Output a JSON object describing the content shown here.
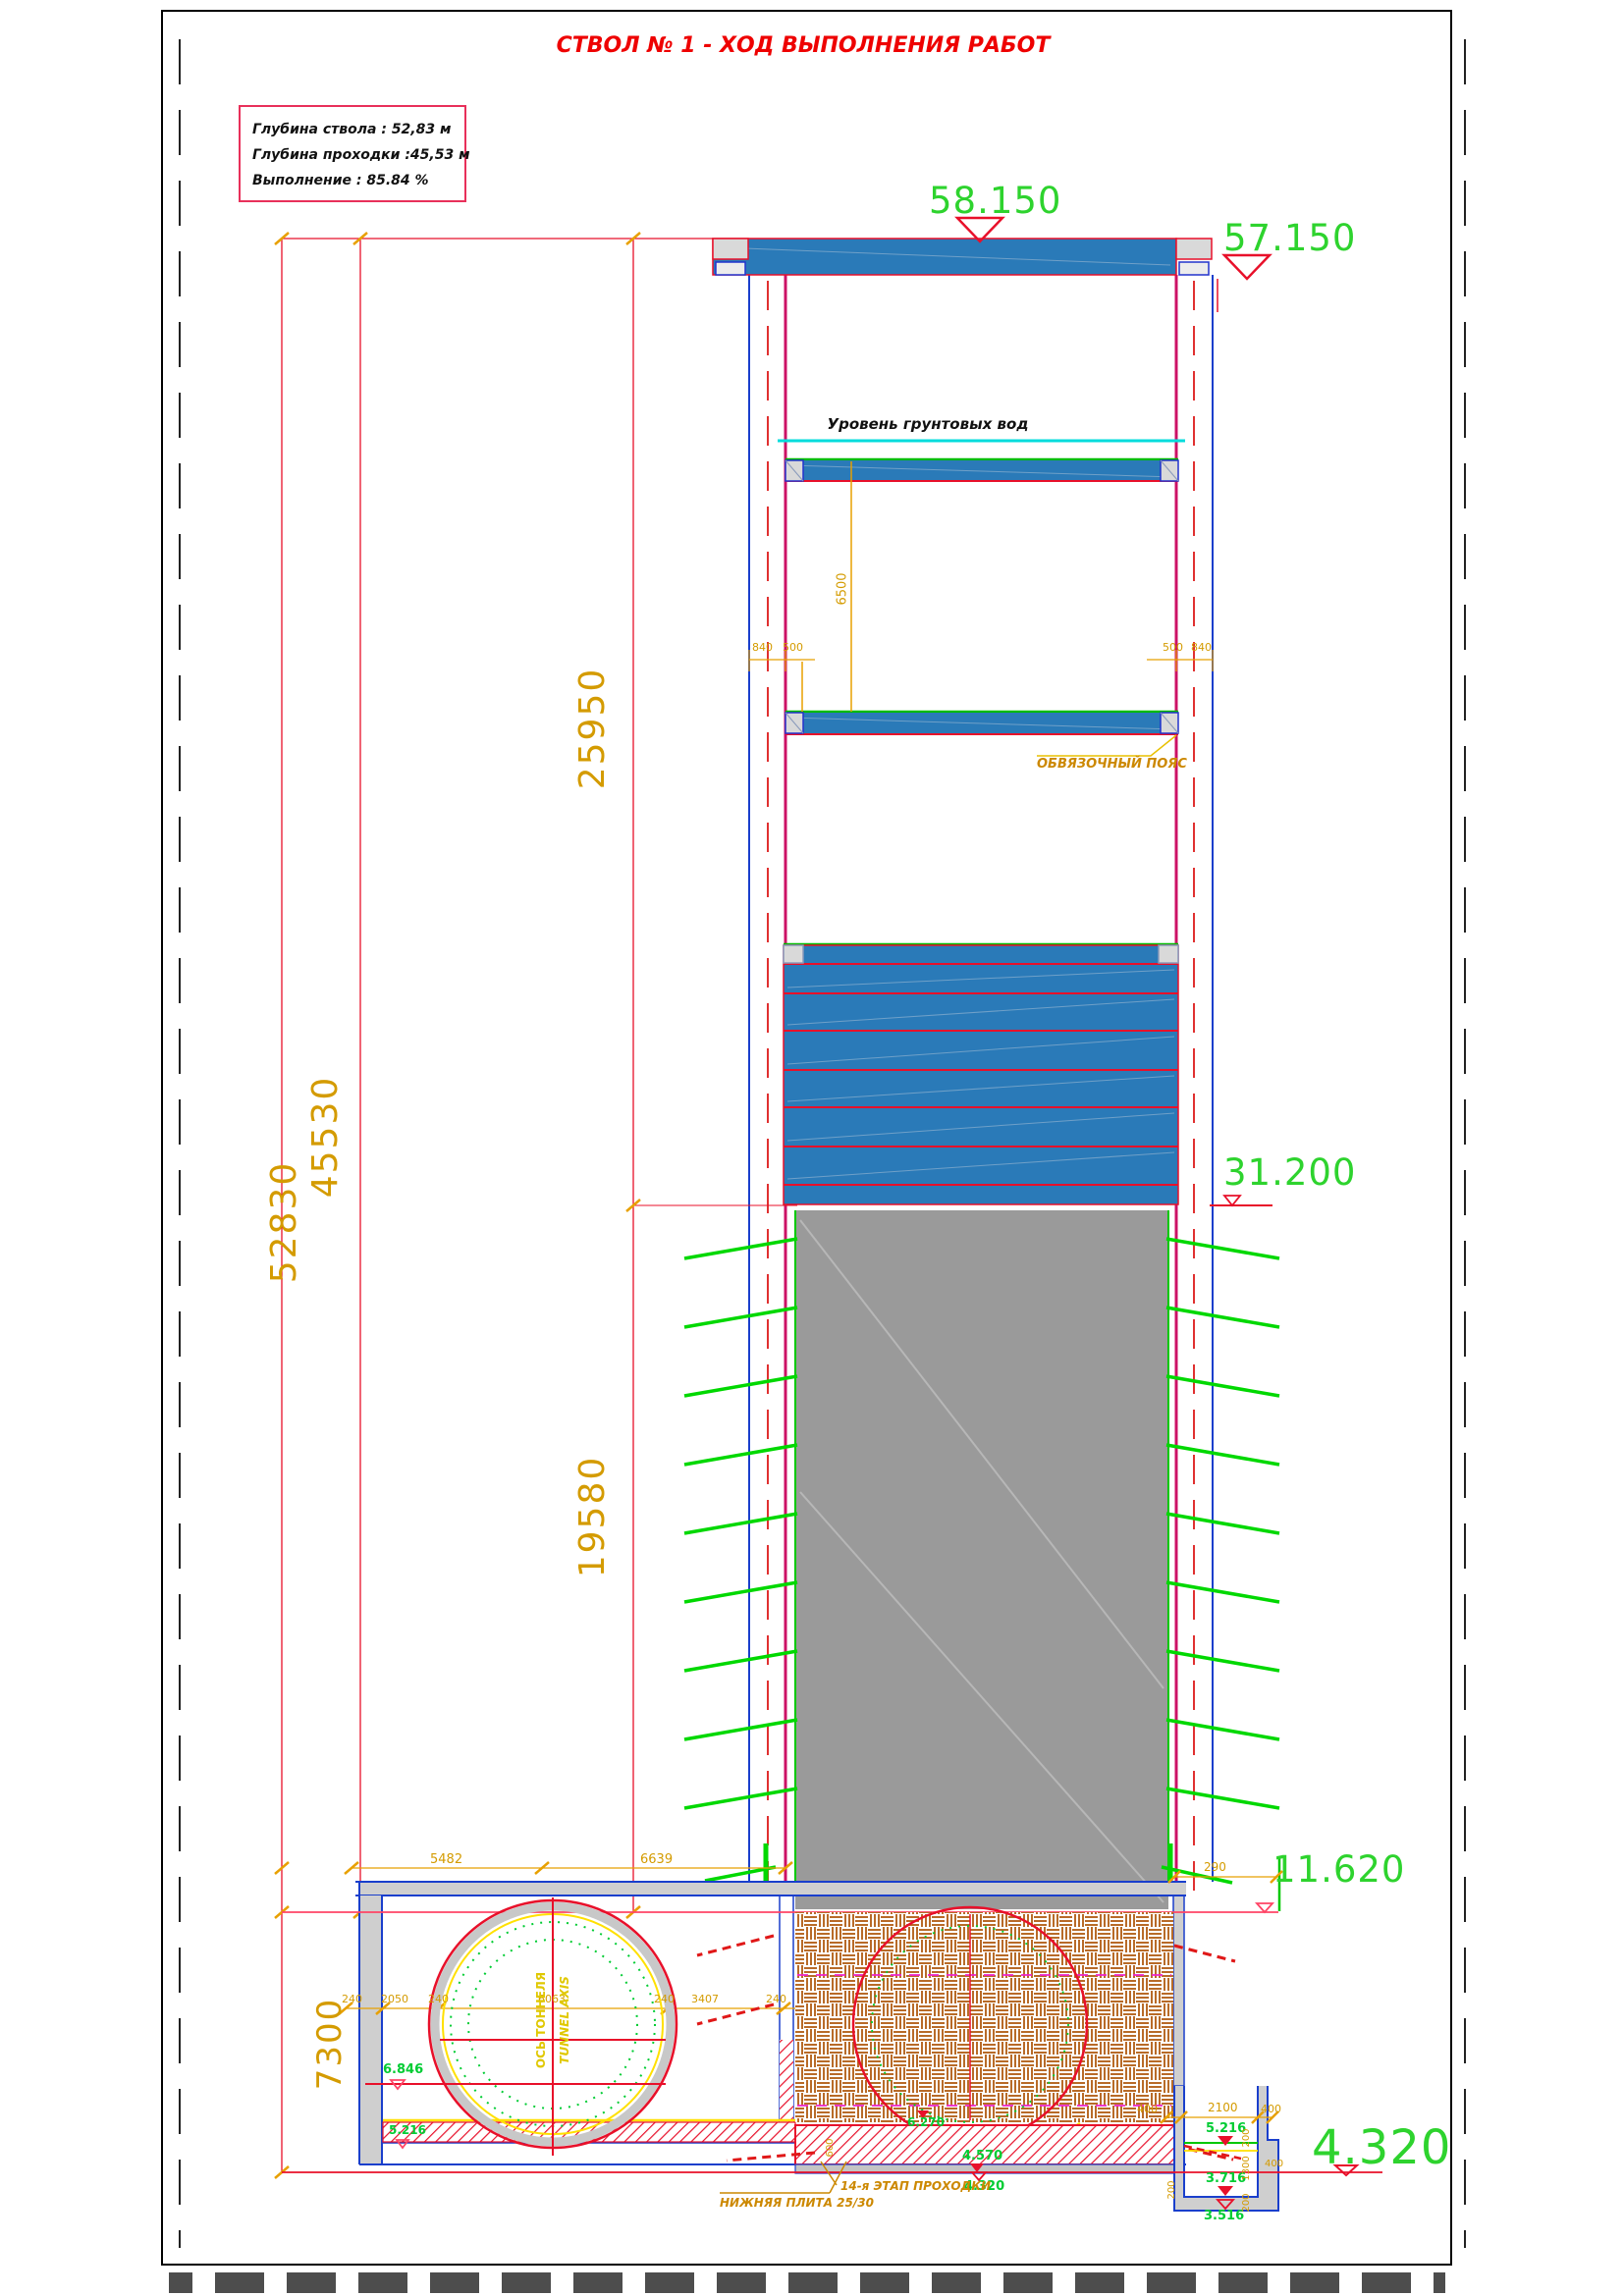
{
  "title": "СТВОЛ № 1 - ХОД ВЫПОЛНЕНИЯ РАБОТ",
  "info": {
    "depth_shaft": "Глубина ствола : 52,83 м",
    "depth_advance": "Глубина проходки :45,53 м",
    "completion": "Выполнение : 85.84 %"
  },
  "labels": {
    "groundwater": "Уровень грунтовых вод",
    "tie_belt": "ОБВЯЗОЧНЫЙ ПОЯС",
    "tunnel_axis_ru": "ОСЬ ТОННЕЛЯ",
    "tunnel_axis_en": "TUNNEL AXIS",
    "bottom_slab": "НИЖНЯЯ ПЛИТА 25/30",
    "stage": "14-я ЭТАП ПРОХОДКИ"
  },
  "elevations": {
    "surface": "58.150",
    "collar": "57.150",
    "lining_bottom": "31.200",
    "excavation_level": "11.620",
    "shaft_bottom_big": "4.320",
    "tunnel_springline": "6.846",
    "gallery_floor": "5.216",
    "masonry_level": "6.270",
    "slab_top": "4.570",
    "slab_bottom": "4.320",
    "sump_top": "5.216",
    "sump_mid": "3.716",
    "sump_bottom": "3.516"
  },
  "dims": {
    "total_depth": "52830",
    "advance_depth": "45530",
    "upper_section": "25950",
    "lower_section": "19580",
    "gallery_height": "7300",
    "level_spacing": "6500",
    "wall_left_a": "840",
    "wall_left_b": "500",
    "wall_right_a": "500",
    "wall_right_b": "840",
    "gallery_top_a": "5482",
    "gallery_top_b": "6639",
    "row": [
      "240",
      "2050",
      "240",
      "6063",
      "240",
      "3407",
      "240"
    ],
    "pit_offset": "290",
    "sump_side_a": "400",
    "sump_width": "2100",
    "sump_side_b": "400",
    "sump_v": [
      "200",
      "1300",
      "200"
    ],
    "sump_step": "400",
    "sump_left": "200",
    "slab_thickness": "600"
  },
  "colors": {
    "accent_red": "#e8102a",
    "elevation_green": "#2ed32e",
    "dimension_orange": "#d49b00",
    "lining_blue": "#2a7ab8",
    "groundwater_cyan": "#00dcdc",
    "excavation_gray": "#9a9a9a"
  }
}
